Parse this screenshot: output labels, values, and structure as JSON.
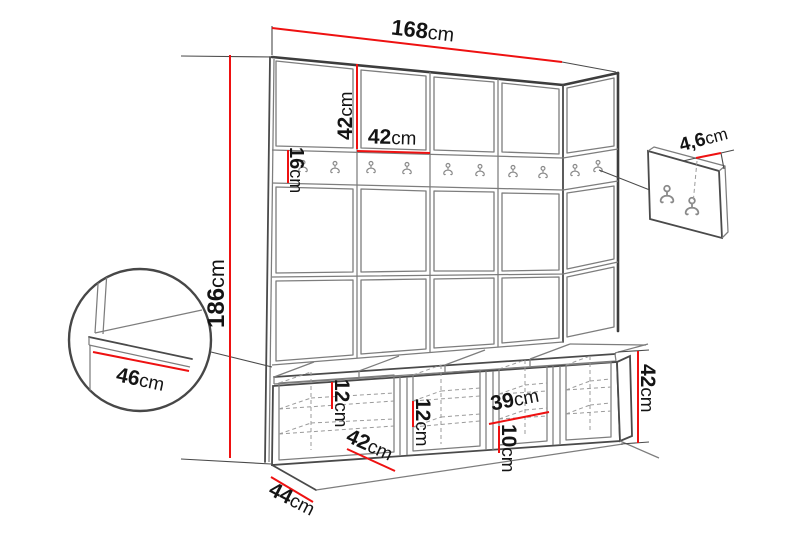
{
  "colors": {
    "dimension_red": "#ee1111",
    "outline_dark": "#3d3d3d",
    "line_light": "#7d7d7d",
    "background": "#ffffff",
    "label_text": "#141414"
  },
  "dimensions": {
    "total_width": {
      "v": "168",
      "u": "cm"
    },
    "upper_panel_height": {
      "v": "42",
      "u": "cm"
    },
    "upper_panel_width": {
      "v": "42",
      "u": "cm"
    },
    "hook_rail_height": {
      "v": "16",
      "u": "cm"
    },
    "total_height": {
      "v": "186",
      "u": "cm"
    },
    "hook_panel_depth": {
      "v": "4,6",
      "u": "cm"
    },
    "seat_depth_detail": {
      "v": "46",
      "u": "cm"
    },
    "shelf_gap_top": {
      "v": "12",
      "u": "cm"
    },
    "shelf_gap_middle": {
      "v": "12",
      "u": "cm"
    },
    "compartment_width": {
      "v": "39",
      "u": "cm"
    },
    "shelf_gap_bottom": {
      "v": "10",
      "u": "cm"
    },
    "bench_height": {
      "v": "42",
      "u": "cm"
    },
    "bench_section_width": {
      "v": "42",
      "u": "cm"
    },
    "bench_total_depth": {
      "v": "44",
      "u": "cm"
    }
  }
}
